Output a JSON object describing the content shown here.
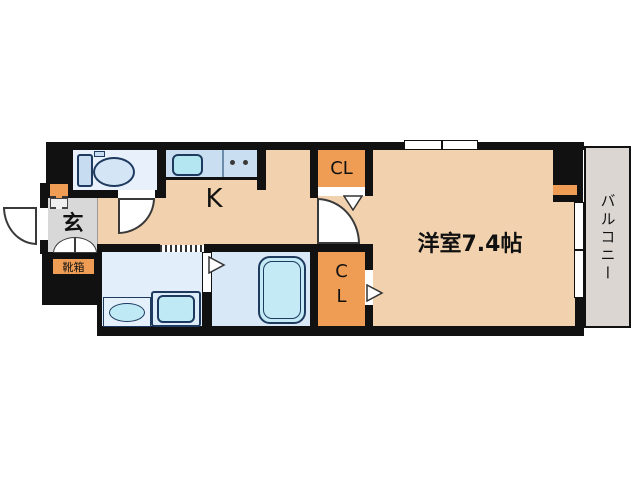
{
  "plan_title": "1K apartment floor plan",
  "rooms": {
    "entrance": {
      "label": "玄"
    },
    "shoe_box": {
      "label": "靴箱"
    },
    "kitchen": {
      "label": "K"
    },
    "closet_upper": {
      "label": "CL"
    },
    "closet_lower": {
      "label": "C\nL"
    },
    "western_room": {
      "label": "洋室7.4帖",
      "size_jo": 7.4
    },
    "balcony": {
      "label": "バルコニー"
    }
  },
  "colors": {
    "wall": "#111111",
    "room_floor_peach": "#f2d2ae",
    "accent_orange": "#ef9d55",
    "entrance_gray": "#d8d8d8",
    "balcony_gray": "#dbd6d2",
    "toilet_room_blue": "#e7f0fb",
    "washroom_blue": "#e2eefa",
    "bathroom_blue": "#d9e8f6",
    "kitchen_counter_blue": "#c9def1",
    "fixture_cyan": "#bfe9f4",
    "fixture_outline_navy": "#1e3a5f"
  }
}
